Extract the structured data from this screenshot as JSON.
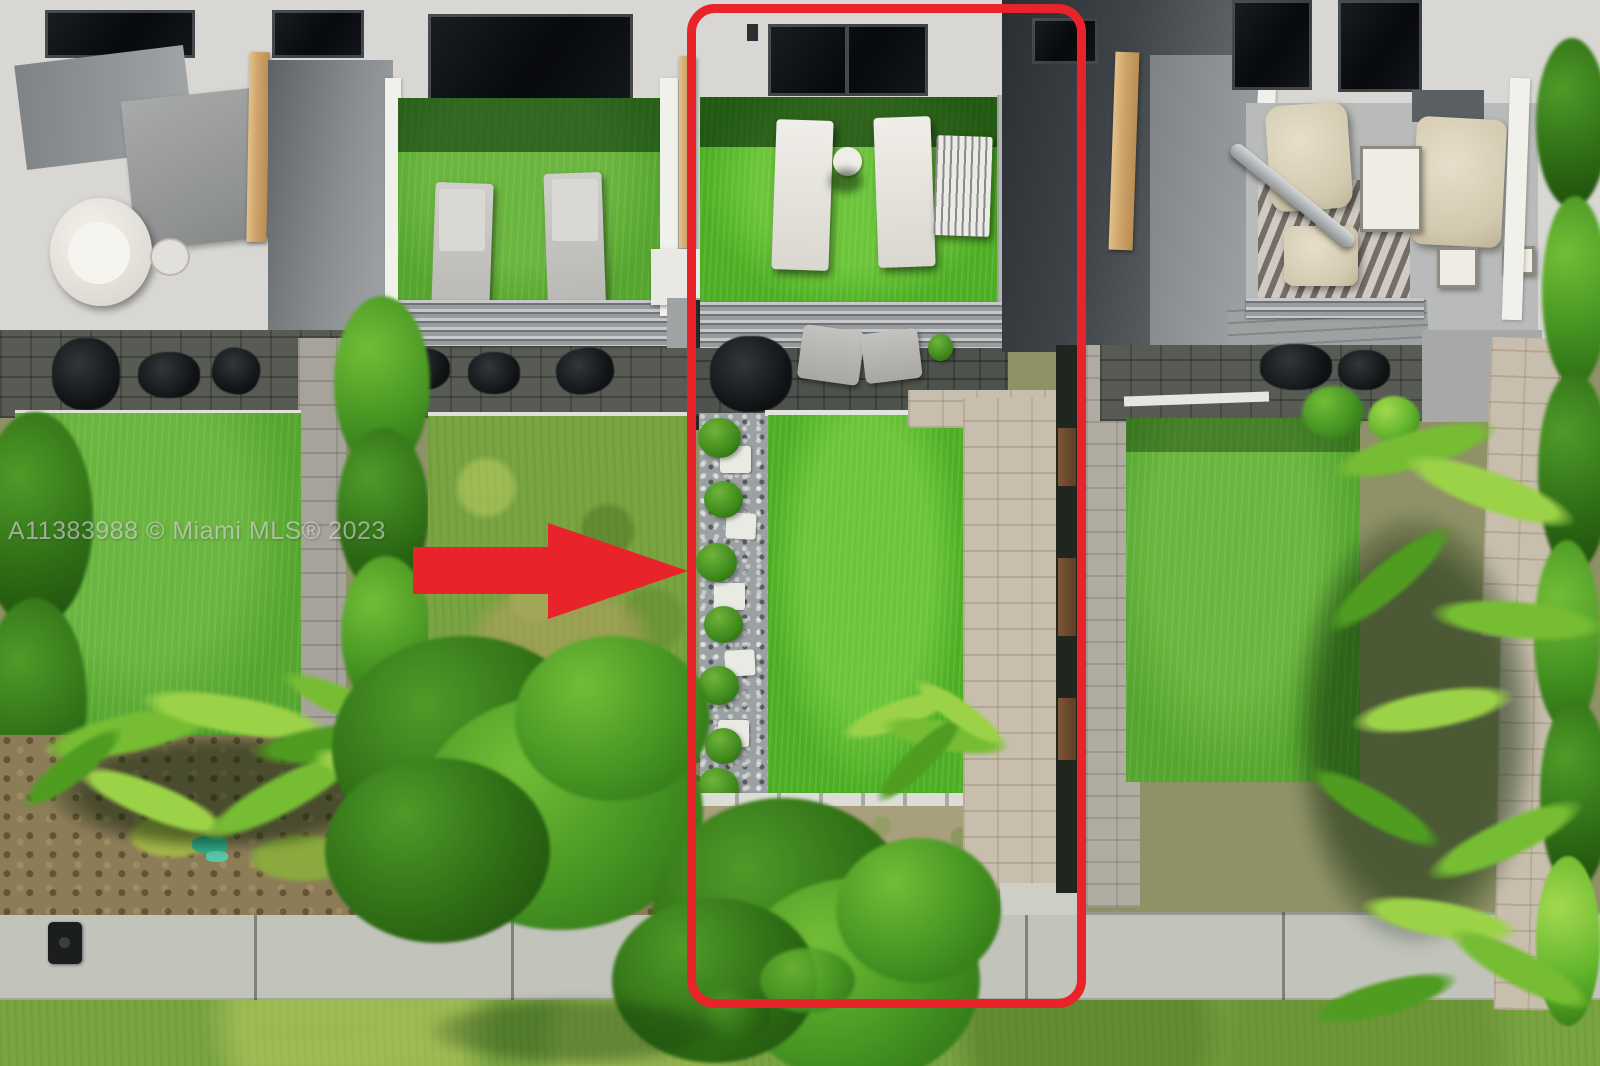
{
  "watermark": {
    "text": "A11383988 © Miami MLS® 2023"
  },
  "annotations": {
    "highlight_box": {
      "shape": "rounded-rectangle",
      "color": "#e8232a",
      "target": "listed townhouse unit and backyard"
    },
    "arrow": {
      "shape": "right-arrow",
      "color": "#e8232a",
      "target": "highlighted unit boundary"
    }
  },
  "palette": {
    "annotation_red": "#e8232a",
    "turf_green": "#4cae22",
    "yard_green": "#55a52e",
    "lawn_green": "#79a441",
    "hedge_green": "#2e6d15",
    "sidewalk_concrete": "#c2c4bc",
    "paver_gray": "#a6a39b",
    "paver_beige": "#c8bead",
    "roof_charcoal": "#2c3135",
    "building_white": "#e9e8e4",
    "glass_black": "#0b0e11",
    "wood_tan": "#cda36a"
  },
  "scene": {
    "type": "aerial-drone-photo",
    "subject": "row of townhouses with turf roof patios, backyards, paver walkways, sidewalk and lawn"
  }
}
